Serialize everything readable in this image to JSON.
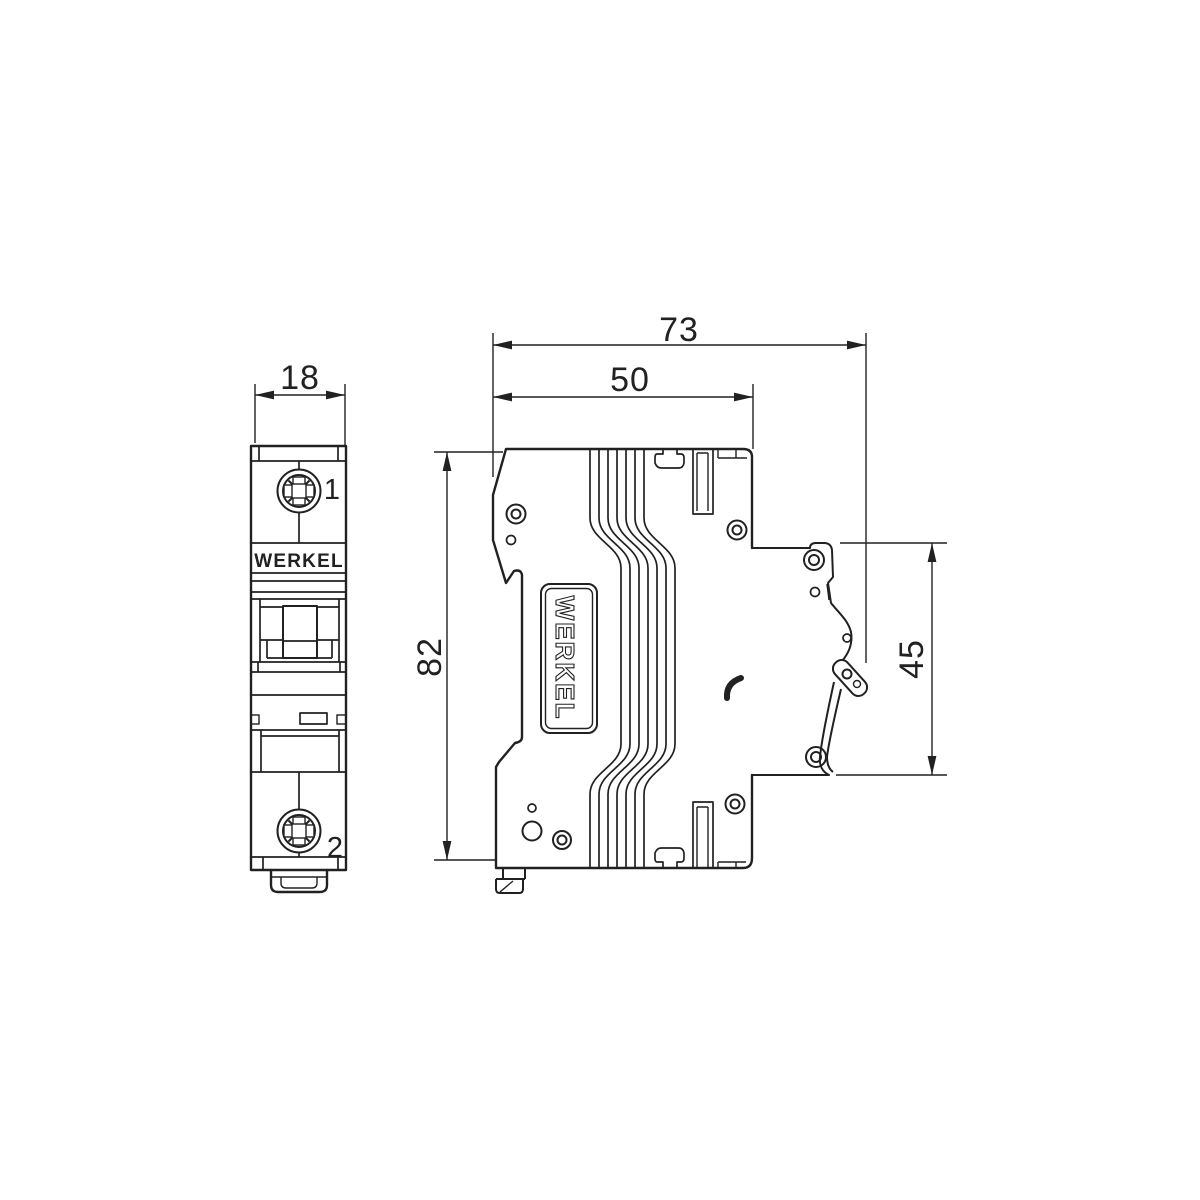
{
  "drawing": {
    "brand": "WERKEL",
    "line_color": "#212121",
    "background_color": "#ffffff",
    "views": {
      "front": {
        "name": "front-view",
        "width_mm": "18",
        "terminal_top_label": "1",
        "terminal_bottom_label": "2",
        "brand_label": "WERKEL"
      },
      "side": {
        "name": "side-view",
        "overall_width_mm": "73",
        "front_section_width_mm": "50",
        "height_mm": "82",
        "din_section_height_mm": "45",
        "brand_label": "WERKEL"
      }
    }
  }
}
